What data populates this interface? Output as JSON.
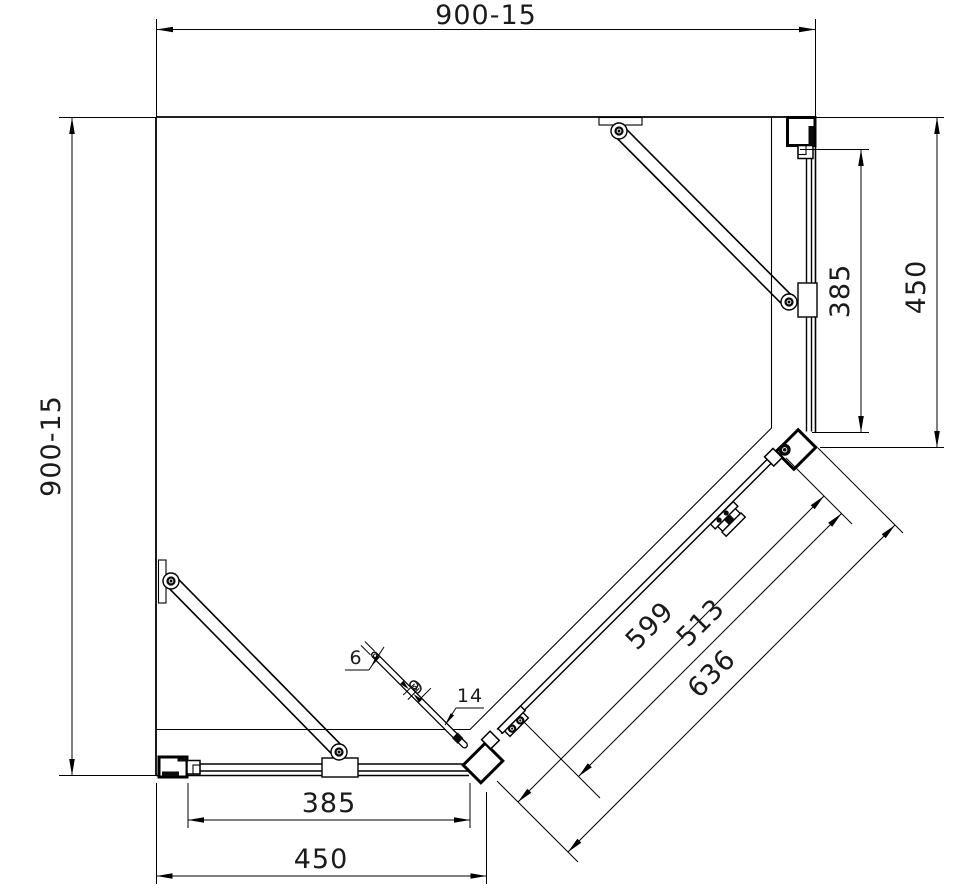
{
  "drawing": {
    "type": "shower-enclosure-plan-view",
    "colors": {
      "line": "#000000",
      "text": "#1b1b1b",
      "background": "#ffffff"
    },
    "dims": {
      "top_width": "900-15",
      "left_height": "900-15",
      "right_panel": "385",
      "right_overall": "450",
      "bottom_panel": "385",
      "bottom_overall": "450",
      "diag_opening": "599",
      "diag_door": "513",
      "diag_overall": "636",
      "handle_thickness": "6",
      "handle_offset": "9",
      "profile_width": "14"
    }
  }
}
